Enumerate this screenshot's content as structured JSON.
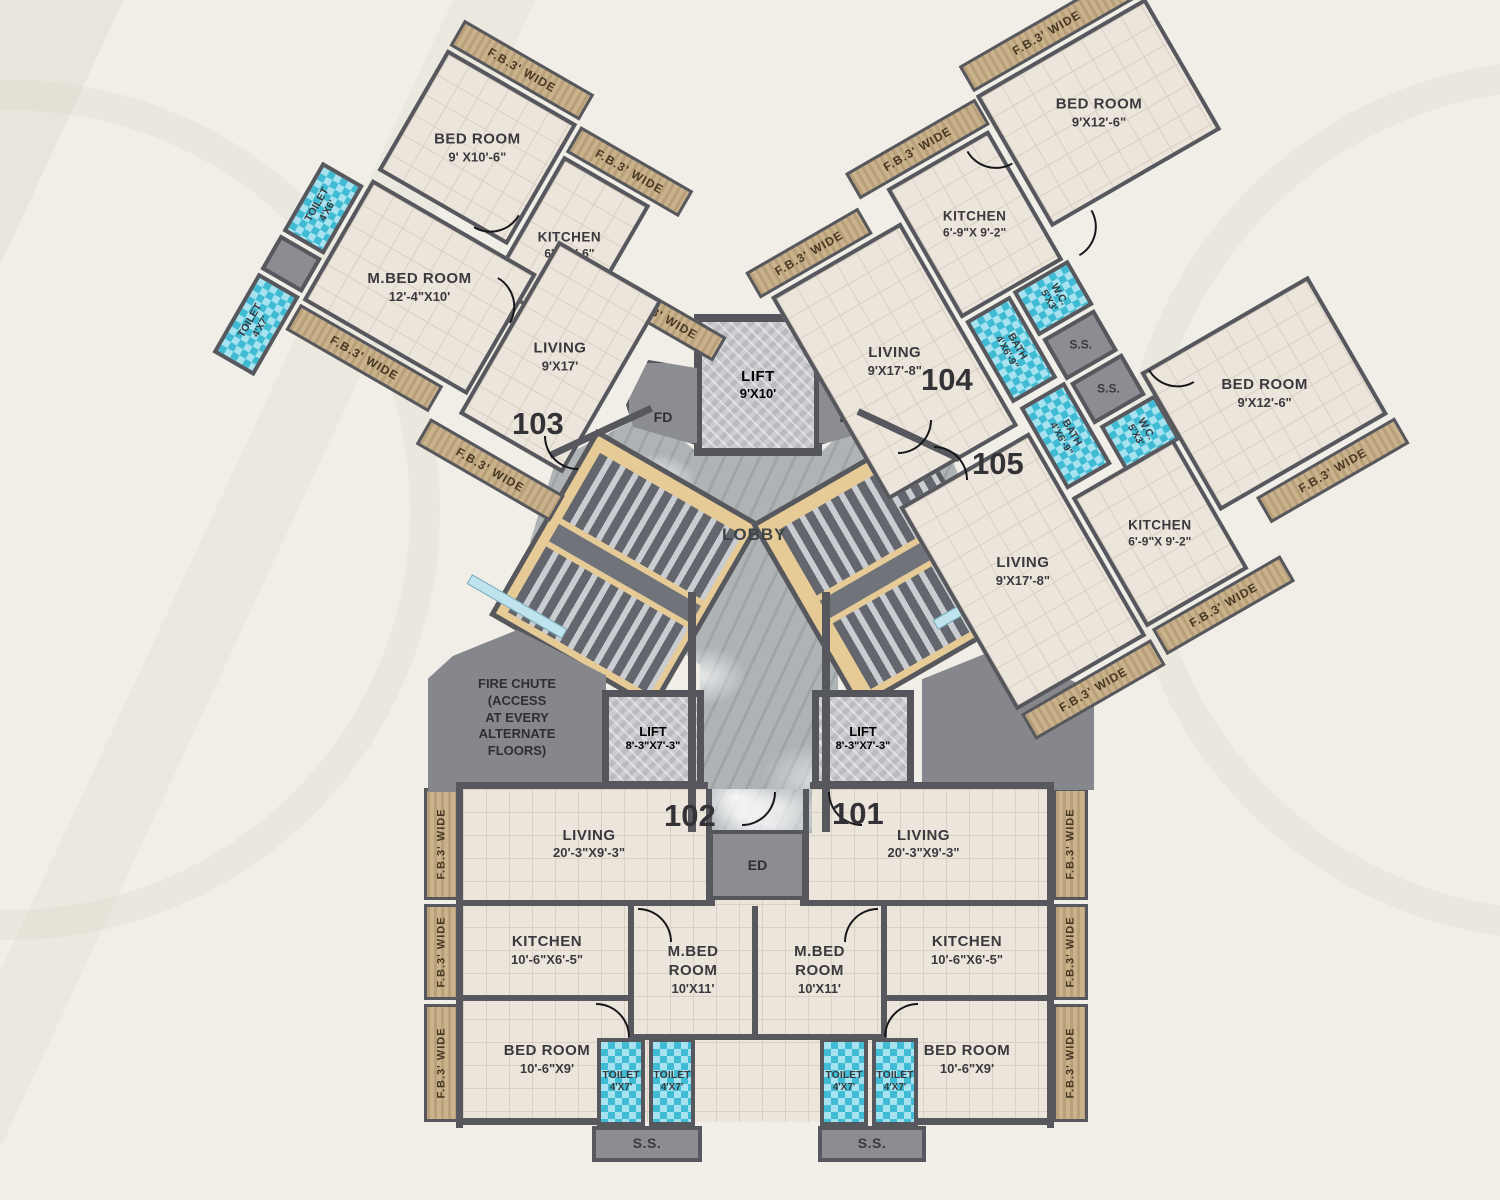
{
  "plan_title": "Typical Floor Plan",
  "labels": {
    "fb_wide": "F.B.3' WIDE",
    "fb_w": "F.B.3' W"
  },
  "colors": {
    "wall": "#56585d",
    "floor": "#ece5dc",
    "balcony": "#c9b28c",
    "water_tile": "#3fbcd4",
    "stair": "#e6cb97",
    "marble": "#aeb3b6",
    "gray_room": "#8b8d92",
    "background": "#f0eee7"
  },
  "common": {
    "lobby": "LOBBY",
    "lift_main": {
      "name": "LIFT",
      "dims": "9'X10'"
    },
    "lift_left": {
      "name": "LIFT",
      "dims": "8'-3\"X7'-3\""
    },
    "lift_right": {
      "name": "LIFT",
      "dims": "8'-3\"X7'-3\""
    },
    "fd": "FD",
    "lvd": "LVD",
    "ed": "ED",
    "fire_chute": "FIRE CHUTE\n(ACCESS\nAT EVERY\nALTERNATE\nFLOORS)"
  },
  "cluster": {
    "wc_a": {
      "name": "W.C.",
      "dims": "5'X3'"
    },
    "wc_b": {
      "name": "W.C.",
      "dims": "5'X3'"
    },
    "bath_a": {
      "name": "BATH",
      "dims": "4'X6'-9\""
    },
    "bath_b": {
      "name": "BATH",
      "dims": "4'X6'-9\""
    },
    "ss_a": "S.S.",
    "ss_b": "S.S."
  },
  "units": {
    "u103": {
      "number": "103",
      "bedroom": {
        "name": "BED ROOM",
        "dims": "9' X10'-6\""
      },
      "kitchen": {
        "name": "KITCHEN",
        "dims": "6'X10'-6\""
      },
      "mbedroom": {
        "name": "M.BED ROOM",
        "dims": "12'-4\"X10'"
      },
      "living": {
        "name": "LIVING",
        "dims": "9'X17'"
      },
      "toilet_a": {
        "name": "TOILET",
        "dims": "4'X6'"
      },
      "toilet_b": {
        "name": "TOILET",
        "dims": "4'X7'"
      }
    },
    "u104": {
      "number": "104",
      "bedroom": {
        "name": "BED ROOM",
        "dims": "9'X12'-6\""
      },
      "kitchen": {
        "name": "KITCHEN",
        "dims": "6'-9\"X 9'-2\""
      },
      "living": {
        "name": "LIVING",
        "dims": "9'X17'-8\""
      }
    },
    "u105": {
      "number": "105",
      "bedroom": {
        "name": "BED ROOM",
        "dims": "9'X12'-6\""
      },
      "kitchen": {
        "name": "KITCHEN",
        "dims": "6'-9\"X 9'-2\""
      },
      "living": {
        "name": "LIVING",
        "dims": "9'X17'-8\""
      }
    },
    "u102": {
      "number": "102",
      "living": {
        "name": "LIVING",
        "dims": "20'-3\"X9'-3\""
      },
      "kitchen": {
        "name": "KITCHEN",
        "dims": "10'-6\"X6'-5\""
      },
      "bedroom": {
        "name": "BED ROOM",
        "dims": "10'-6\"X9'"
      },
      "mbedroom": {
        "name": "M.BED ROOM",
        "dims": "10'X11'"
      },
      "toilet_a": {
        "name": "TOILET",
        "dims": "4'X7'"
      },
      "toilet_b": {
        "name": "TOILET",
        "dims": "4'X7'"
      },
      "ss": "S.S."
    },
    "u101": {
      "number": "101",
      "living": {
        "name": "LIVING",
        "dims": "20'-3\"X9'-3\""
      },
      "kitchen": {
        "name": "KITCHEN",
        "dims": "10'-6\"X6'-5\""
      },
      "bedroom": {
        "name": "BED ROOM",
        "dims": "10'-6\"X9'"
      },
      "mbedroom": {
        "name": "M.BED ROOM",
        "dims": "10'X11'"
      },
      "toilet_a": {
        "name": "TOILET",
        "dims": "4'X7'"
      },
      "toilet_b": {
        "name": "TOILET",
        "dims": "4'X7'"
      },
      "ss": "S.S."
    }
  }
}
